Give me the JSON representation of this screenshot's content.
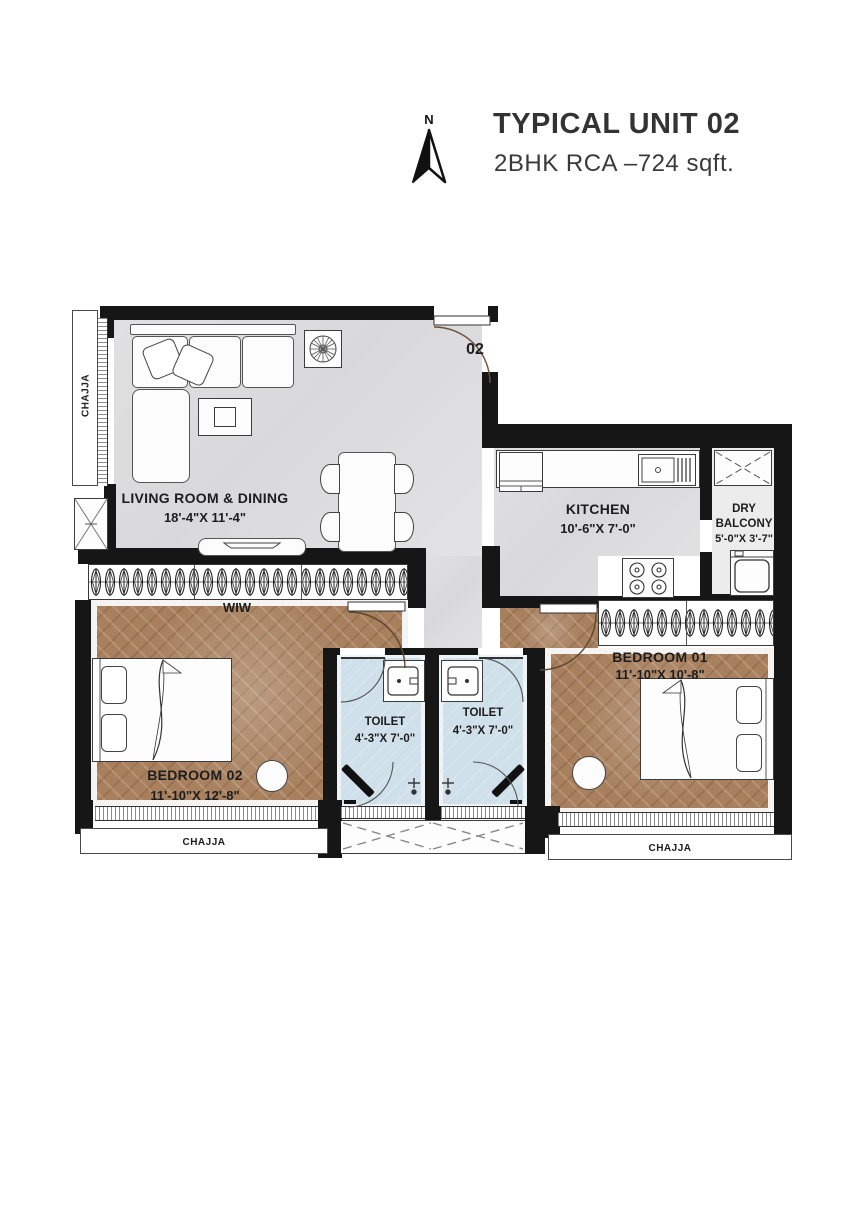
{
  "header": {
    "title": "TYPICAL UNIT 02",
    "subtitle": "2BHK RCA –724 sqft.",
    "north_label": "N"
  },
  "unit_number": "02",
  "rooms": {
    "living": {
      "name": "LIVING ROOM & DINING",
      "dim": "18'-4\"X 11'-4\""
    },
    "kitchen": {
      "name": "KITCHEN",
      "dim": "10'-6\"X 7'-0\""
    },
    "dry_balcony": {
      "name": "DRY BALCONY",
      "dim": "5'-0\"X 3'-7\""
    },
    "bedroom_01": {
      "name": "BEDROOM 01",
      "dim": "11'-10\"X 10'-8\""
    },
    "bedroom_02": {
      "name": "BEDROOM 02",
      "dim": "11'-10\"X 12'-8\""
    },
    "toilet_left": {
      "name": "TOILET",
      "dim": "4'-3\"X 7'-0\""
    },
    "toilet_right": {
      "name": "TOILET",
      "dim": "4'-3\"X 7'-0\""
    },
    "wiw": {
      "name": "WIW"
    }
  },
  "annotations": {
    "chajja_left": "CHAJJA",
    "chajja_bottom_left": "CHAJJA",
    "chajja_bottom_right": "CHAJJA"
  },
  "colors": {
    "wall": "#161616",
    "floor_tile": "#dcdcde",
    "floor_wood": "#a8805e",
    "floor_toilet": "#cfe0ea",
    "background": "#ffffff"
  }
}
